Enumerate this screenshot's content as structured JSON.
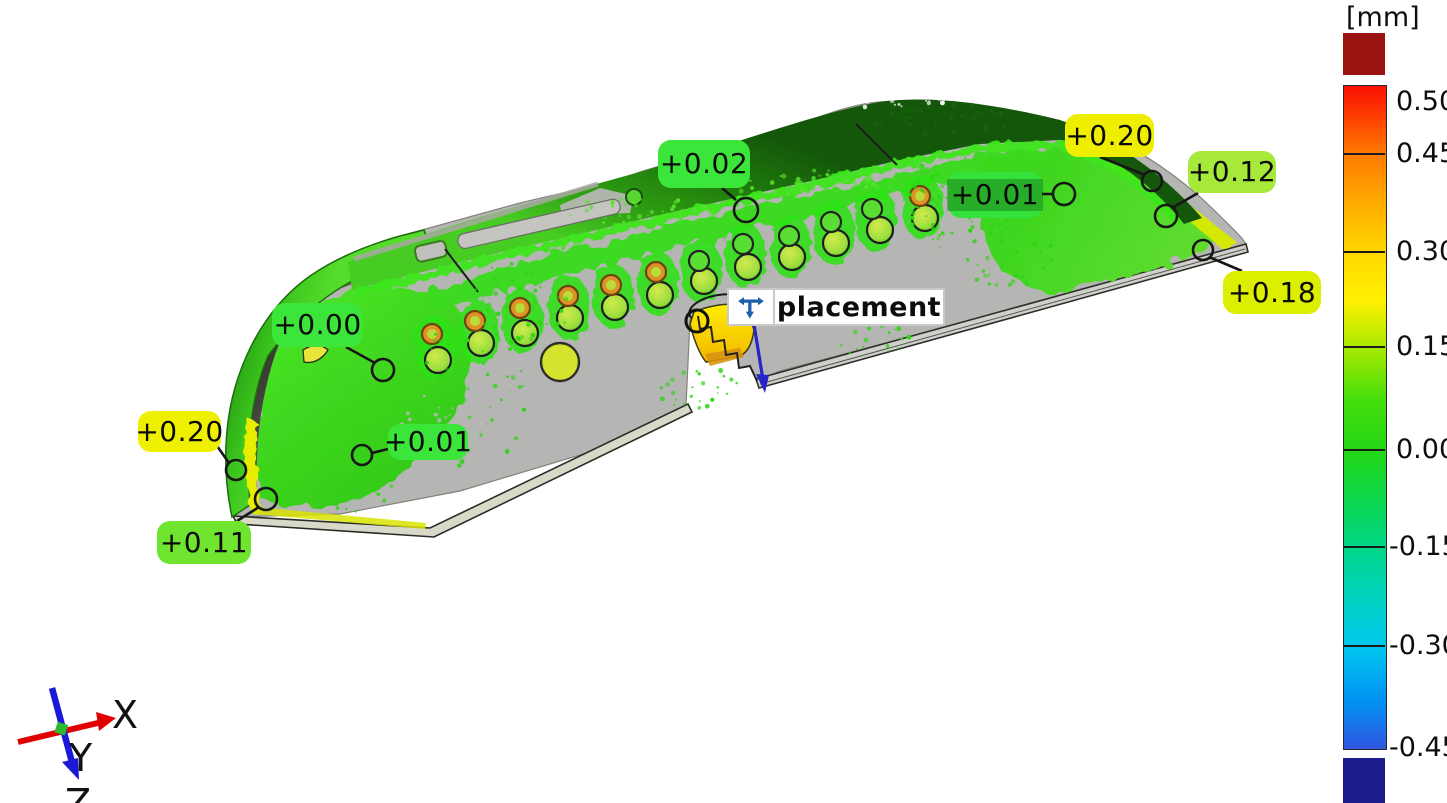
{
  "view": {
    "background_color": "#ffffff",
    "description": "3D surface deviation inspection viewport"
  },
  "color_scale": {
    "unit_label": "[mm]",
    "tick_labels": [
      "0.50",
      "0.45",
      "0.30",
      "0.15",
      "0.00",
      "-0.15",
      "-0.30",
      "-0.45"
    ],
    "tick_y": [
      102,
      154,
      252,
      347,
      450,
      547,
      646,
      748
    ],
    "bar": {
      "x": 1343,
      "width": 42,
      "top": 85,
      "bottom": 748
    },
    "overflow_top_color": "#9c1412",
    "overflow_bottom_color": "#1b1b8c",
    "gradient_stops": [
      [
        0,
        "#fb0f00"
      ],
      [
        10.4,
        "#ff7b00"
      ],
      [
        17.4,
        "#ffaa00"
      ],
      [
        25.2,
        "#ffd800"
      ],
      [
        32.4,
        "#fff000"
      ],
      [
        39.5,
        "#a8ea00"
      ],
      [
        47.5,
        "#44dd0c"
      ],
      [
        55.1,
        "#22d614"
      ],
      [
        62.6,
        "#0bd74f"
      ],
      [
        69.7,
        "#00d687"
      ],
      [
        77.7,
        "#00d3c4"
      ],
      [
        84.6,
        "#00c6ee"
      ],
      [
        92.8,
        "#0092f2"
      ],
      [
        100,
        "#3156e2"
      ]
    ]
  },
  "annotations": [
    {
      "label": "+0.02",
      "color": "#3ce53a",
      "selected": false,
      "box": [
        658,
        140,
        92,
        48
      ],
      "circle": [
        746,
        210,
        12
      ],
      "leader": [
        722,
        188,
        736,
        200
      ]
    },
    {
      "label": "+0.01",
      "color": "#35e23c",
      "selected": true,
      "box": [
        948,
        172,
        94,
        46
      ],
      "circle": [
        1064,
        194,
        11
      ],
      "leader": [
        1042,
        194,
        1053,
        194
      ]
    },
    {
      "label": "+0.20",
      "color": "#f0ee00",
      "selected": false,
      "box": [
        1065,
        114,
        89,
        43
      ],
      "circle": [
        1152,
        181,
        10
      ],
      "leader": [
        1100,
        157,
        1145,
        175
      ]
    },
    {
      "label": "+0.12",
      "color": "#a6e93a",
      "selected": false,
      "box": [
        1188,
        151,
        88,
        42
      ],
      "circle": [
        1166,
        216,
        11
      ],
      "leader": [
        1198,
        193,
        1172,
        208
      ]
    },
    {
      "label": "+0.18",
      "color": "#ddef00",
      "selected": false,
      "box": [
        1223,
        271,
        98,
        43
      ],
      "circle": [
        1203,
        250,
        10
      ],
      "leader": [
        1242,
        271,
        1209,
        257
      ]
    },
    {
      "label": "+0.00",
      "color": "#3ce53a",
      "selected": false,
      "box": [
        272,
        303,
        91,
        44
      ],
      "circle": [
        383,
        370,
        11
      ],
      "leader": [
        346,
        347,
        375,
        363
      ]
    },
    {
      "label": "+0.20",
      "color": "#eef000",
      "selected": false,
      "box": [
        138,
        411,
        83,
        41
      ],
      "circle": [
        236,
        470,
        10
      ],
      "leader": [
        215,
        443,
        229,
        463
      ]
    },
    {
      "label": "+0.01",
      "color": "#3ce53a",
      "selected": false,
      "box": [
        388,
        424,
        80,
        36
      ],
      "circle": [
        362,
        455,
        10
      ],
      "leader": [
        388,
        449,
        372,
        453
      ]
    },
    {
      "label": "+0.11",
      "color": "#70e52f",
      "selected": false,
      "box": [
        157,
        521,
        94,
        43
      ],
      "circle": [
        266,
        499,
        11
      ],
      "leader": [
        237,
        521,
        259,
        507
      ]
    }
  ],
  "placement": {
    "text": "placement",
    "icon": "placement-move-icon",
    "icon_color": "#1e5fa9"
  },
  "axis_triad": {
    "x_label": "X",
    "y_label": "Y",
    "z_label": "Z",
    "x_color": "#e10000",
    "z_color": "#1a1ad6",
    "y_marker_color": "#2db82d",
    "label_color": "#111111"
  }
}
